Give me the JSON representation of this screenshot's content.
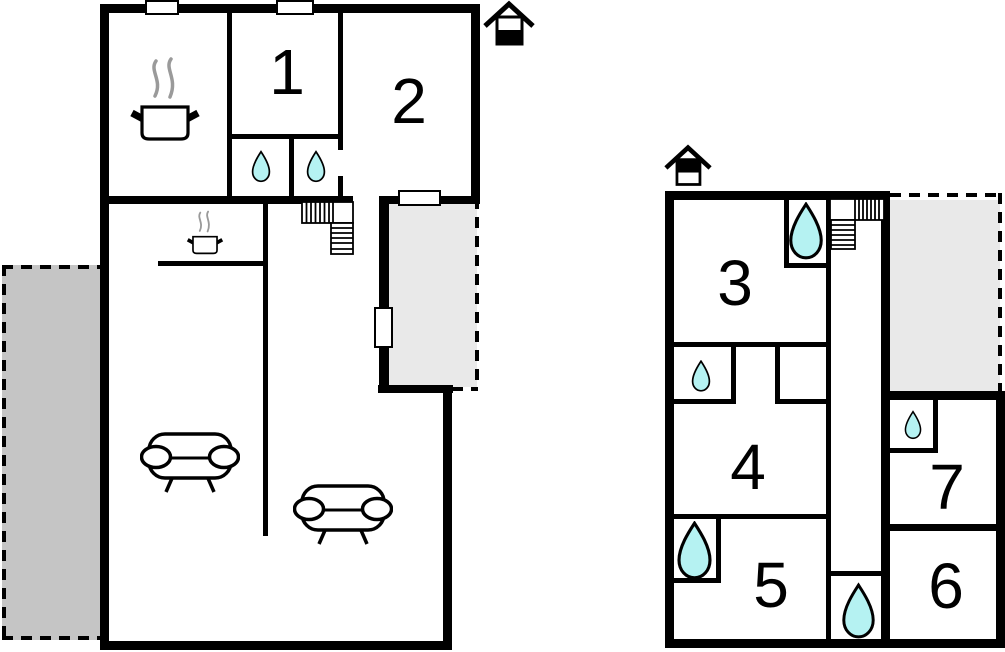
{
  "colors": {
    "wall": "#000000",
    "left_terrace_fill": "#c5c5c5",
    "right_terrace_fill": "#e9e9e9",
    "water_drop": "#b5f2f2",
    "steam": "#9a9a9a"
  },
  "left_plan": {
    "name": "main-building-floor-plan",
    "rooms": [
      {
        "label": "1"
      },
      {
        "label": "2"
      }
    ],
    "icons": {
      "chimney": "chimney-icon",
      "stove": "stove-pot-icon",
      "kitchenette_stove": "small-pot-icon",
      "water_drops": 2,
      "sofas": 2,
      "stairs": 1,
      "windows": 3,
      "terrace_doors": 1,
      "terraces": 2
    }
  },
  "right_plan": {
    "name": "upper-building-floor-plan",
    "rooms": [
      {
        "label": "3"
      },
      {
        "label": "4"
      },
      {
        "label": "5"
      },
      {
        "label": "6"
      },
      {
        "label": "7"
      }
    ],
    "icons": {
      "chimney": "chimney-icon",
      "water_drops": 5,
      "stairs": 1,
      "terraces": 1
    }
  }
}
